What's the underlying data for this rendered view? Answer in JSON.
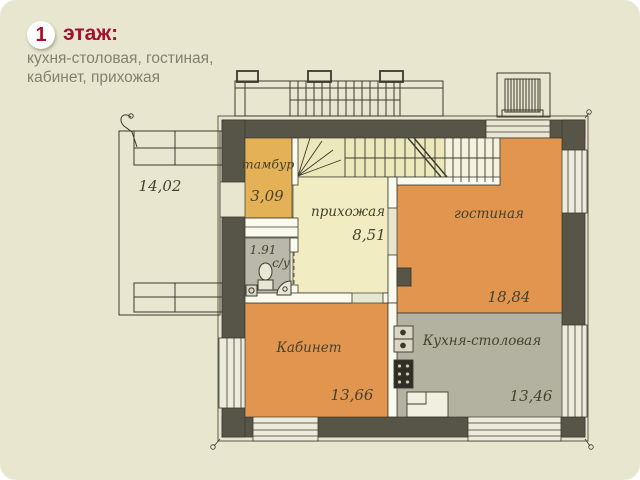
{
  "header": {
    "floor_number": "1",
    "floor_word": "этаж:",
    "subtitle_line1": "кухня-столовая, гостиная,",
    "subtitle_line2": "кабинет, прихожая"
  },
  "plan": {
    "terrace": {
      "area": "14,02"
    },
    "tambur": {
      "name": "тамбур",
      "area": "3,09"
    },
    "hallway": {
      "name": "прихожая",
      "area": "8,51"
    },
    "living": {
      "name": "гостиная",
      "area": "18,84"
    },
    "office": {
      "name": "Кабинет",
      "area": "13,66"
    },
    "kitchen": {
      "name": "Кухня-столовая",
      "area": "13,46"
    },
    "bathroom": {
      "name": "с/у",
      "area": "1.91"
    }
  },
  "colors": {
    "accent_red": "#a4112e",
    "background": "#e8e6ce",
    "wall_dark": "#575448",
    "wall_white": "#fbfaef",
    "window_light": "#edebdc",
    "room_orange": "#e2954e",
    "room_amber": "#e5b156",
    "room_yellow": "#f1ecc1",
    "stairs_yellow": "#ece8bb",
    "stairs_white": "#f4f1df",
    "kitchen_gray": "#b3b2a1",
    "bath_gray": "#b9b8aa"
  }
}
